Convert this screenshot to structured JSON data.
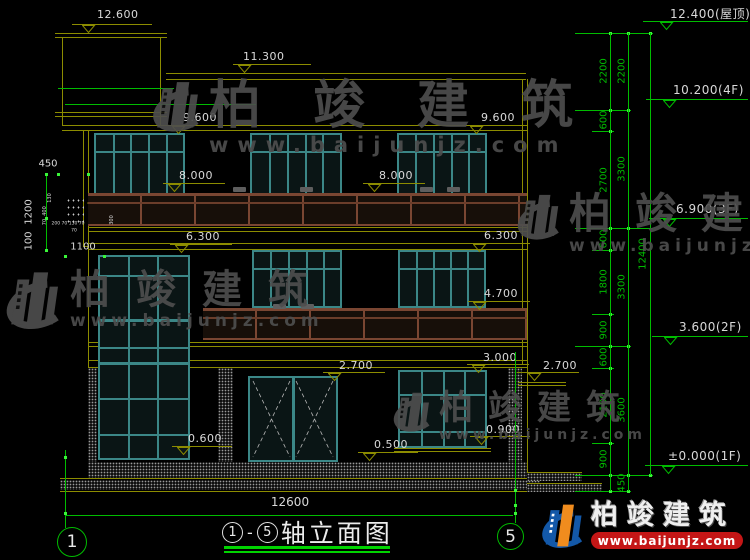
{
  "colors": {
    "line_olive": "#8c8c00",
    "dim_green": "#00bc00",
    "dot_green": "#39f539",
    "window_teal": "#3b8787",
    "railing_brown": "#7a4632",
    "text_white": "#d9d9d9",
    "watermark_gray": "#4e4e4e",
    "logo_blue": "#1358a8",
    "logo_orange": "#f08c1e",
    "logo_red": "#c41616"
  },
  "title_block": {
    "axis_start": "1",
    "dash": "-",
    "axis_end": "5",
    "title": "轴立面图"
  },
  "watermark": {
    "text": "柏竣建筑",
    "url": "www.baijunjz.com",
    "instances": [
      {
        "x": 137,
        "y": 80,
        "logo": 66,
        "cs": 52,
        "ls": 52,
        "us": 21,
        "uls": 9
      },
      {
        "x": -12,
        "y": 270,
        "logo": 76,
        "cs": 40,
        "ls": 26,
        "us": 17,
        "uls": 5
      },
      {
        "x": 503,
        "y": 193,
        "logo": 60,
        "cs": 42,
        "ls": 24,
        "us": 17,
        "uls": 5
      },
      {
        "x": 381,
        "y": 391,
        "logo": 52,
        "cs": 34,
        "ls": 15,
        "us": 14,
        "uls": 4
      }
    ]
  },
  "brand": {
    "text": "柏竣建筑",
    "url": "www.baijunjz.com"
  },
  "elevation_markers": [
    {
      "label": "12.600",
      "c": "o",
      "tx": 97,
      "ty": 8,
      "lx": 72,
      "ly": 24,
      "lw": 80,
      "ax": 82
    },
    {
      "label": "11.300",
      "c": "o",
      "tx": 243,
      "ty": 50,
      "lx": 233,
      "ly": 64,
      "lw": 78,
      "ax": 238
    },
    {
      "label": "9.600",
      "c": "o",
      "tx": 183,
      "ty": 111,
      "lx": 167,
      "ly": 125,
      "lw": 62,
      "ax": 172
    },
    {
      "label": "9.600",
      "c": "o",
      "tx": 481,
      "ty": 111,
      "lx": 465,
      "ly": 125,
      "lw": 62,
      "ax": 470
    },
    {
      "label": "8.000",
      "c": "o",
      "tx": 179,
      "ty": 169,
      "lx": 163,
      "ly": 183,
      "lw": 62,
      "ax": 168
    },
    {
      "label": "8.000",
      "c": "o",
      "tx": 379,
      "ty": 169,
      "lx": 363,
      "ly": 183,
      "lw": 62,
      "ax": 368
    },
    {
      "label": "6.300",
      "c": "o",
      "tx": 186,
      "ty": 230,
      "lx": 170,
      "ly": 244,
      "lw": 62,
      "ax": 175
    },
    {
      "label": "6.300",
      "c": "o",
      "tx": 484,
      "ty": 229,
      "lx": 468,
      "ly": 243,
      "lw": 62,
      "ax": 473
    },
    {
      "label": "4.700",
      "c": "o",
      "tx": 484,
      "ty": 287,
      "lx": 468,
      "ly": 301,
      "lw": 62,
      "ax": 473
    },
    {
      "label": "3.000",
      "c": "o",
      "tx": 483,
      "ty": 351,
      "lx": 467,
      "ly": 364,
      "lw": 62,
      "ax": 472
    },
    {
      "label": "2.700",
      "c": "o",
      "tx": 339,
      "ty": 359,
      "lx": 323,
      "ly": 372,
      "lw": 62,
      "ax": 328
    },
    {
      "label": "2.700",
      "c": "o",
      "tx": 543,
      "ty": 359,
      "lx": 517,
      "ly": 372,
      "lw": 62,
      "ax": 528
    },
    {
      "label": "0.900",
      "c": "o",
      "tx": 486,
      "ty": 423,
      "lx": 470,
      "ly": 436,
      "lw": 60,
      "ax": 475
    },
    {
      "label": "0.600",
      "c": "o",
      "tx": 188,
      "ty": 432,
      "lx": 172,
      "ly": 446,
      "lw": 60,
      "ax": 177
    },
    {
      "label": "0.500",
      "c": "o",
      "tx": 374,
      "ty": 438,
      "lx": 358,
      "ly": 452,
      "lw": 60,
      "ax": 363
    },
    {
      "label": "12.400(屋顶)",
      "c": "g",
      "tx": 670,
      "ty": 5,
      "lx": 643,
      "ly": 21,
      "lw": 105,
      "ax": 660
    },
    {
      "label": "10.200(4F)",
      "c": "g",
      "tx": 673,
      "ty": 83,
      "lx": 646,
      "ly": 99,
      "lw": 102,
      "ax": 663
    },
    {
      "label": "6.900(3F)",
      "c": "g",
      "tx": 676,
      "ty": 202,
      "lx": 649,
      "ly": 218,
      "lw": 99,
      "ax": 663
    },
    {
      "label": "3.600(2F)",
      "c": "g",
      "tx": 679,
      "ty": 320,
      "lx": 652,
      "ly": 336,
      "lw": 96,
      "ax": 664
    },
    {
      "label": "±0.000(1F)",
      "c": "g",
      "tx": 668,
      "ty": 449,
      "lx": 645,
      "ly": 465,
      "lw": 103,
      "ax": 662
    }
  ],
  "dim_labels": [
    {
      "t": "2200",
      "x": 604,
      "y": 71,
      "r": -90,
      "s": 10,
      "c": "g"
    },
    {
      "t": "600",
      "x": 604,
      "y": 120,
      "r": -90,
      "s": 10,
      "c": "g"
    },
    {
      "t": "2700",
      "x": 604,
      "y": 180,
      "r": -90,
      "s": 10,
      "c": "g"
    },
    {
      "t": "600",
      "x": 604,
      "y": 239,
      "r": -90,
      "s": 10,
      "c": "g"
    },
    {
      "t": "1800",
      "x": 604,
      "y": 282,
      "r": -90,
      "s": 10,
      "c": "g"
    },
    {
      "t": "900",
      "x": 604,
      "y": 330,
      "r": -90,
      "s": 10,
      "c": "g"
    },
    {
      "t": "600",
      "x": 604,
      "y": 357,
      "r": -90,
      "s": 10,
      "c": "g"
    },
    {
      "t": "2100",
      "x": 604,
      "y": 405,
      "r": -90,
      "s": 10,
      "c": "g"
    },
    {
      "t": "900",
      "x": 604,
      "y": 459,
      "r": -90,
      "s": 10,
      "c": "g"
    },
    {
      "t": "2200",
      "x": 622,
      "y": 71,
      "r": -90,
      "s": 10,
      "c": "g"
    },
    {
      "t": "3300",
      "x": 622,
      "y": 169,
      "r": -90,
      "s": 10,
      "c": "g"
    },
    {
      "t": "3300",
      "x": 622,
      "y": 287,
      "r": -90,
      "s": 10,
      "c": "g"
    },
    {
      "t": "3600",
      "x": 622,
      "y": 410,
      "r": -90,
      "s": 10,
      "c": "g"
    },
    {
      "t": "450",
      "x": 622,
      "y": 483,
      "r": -90,
      "s": 10,
      "c": "g"
    },
    {
      "t": "12400",
      "x": 643,
      "y": 254,
      "r": -90,
      "s": 10,
      "c": "g"
    },
    {
      "t": "450",
      "x": 48,
      "y": 164,
      "r": 0,
      "s": 10,
      "c": "w"
    },
    {
      "t": "1200",
      "x": 29,
      "y": 212,
      "r": -90,
      "s": 10,
      "c": "w"
    },
    {
      "t": "100",
      "x": 29,
      "y": 241,
      "r": -90,
      "s": 10,
      "c": "w"
    },
    {
      "t": "1100",
      "x": 83,
      "y": 247,
      "r": 0,
      "s": 10,
      "c": "w"
    },
    {
      "t": "12600",
      "x": 290,
      "y": 502,
      "r": 0,
      "s": 12,
      "c": "w"
    },
    {
      "t": "130",
      "x": 50,
      "y": 198,
      "r": -90,
      "s": 5,
      "c": "w"
    },
    {
      "t": "400",
      "x": 45,
      "y": 211,
      "r": -90,
      "s": 5,
      "c": "w"
    },
    {
      "t": "70",
      "x": 45,
      "y": 222,
      "r": -90,
      "s": 5,
      "c": "w"
    },
    {
      "t": "200 70 130 70",
      "x": 68,
      "y": 224,
      "r": 0,
      "s": 4.5,
      "c": "w"
    },
    {
      "t": "70",
      "x": 74,
      "y": 231,
      "r": 0,
      "s": 4.5,
      "c": "w"
    },
    {
      "t": "300",
      "x": 112,
      "y": 220,
      "r": -90,
      "s": 5,
      "c": "w"
    }
  ],
  "green": {
    "rows": [
      {
        "y": 33,
        "x1": 575,
        "x2": 653,
        "dots": [
          610,
          628,
          650
        ]
      },
      {
        "y": 110,
        "x1": 575,
        "x2": 631,
        "dots": [
          610,
          628
        ]
      },
      {
        "y": 131,
        "x1": 592,
        "x2": 614,
        "dots": [
          610
        ]
      },
      {
        "y": 228,
        "x1": 575,
        "x2": 653,
        "dots": [
          610,
          628
        ]
      },
      {
        "y": 250,
        "x1": 592,
        "x2": 614,
        "dots": [
          610
        ]
      },
      {
        "y": 314,
        "x1": 592,
        "x2": 614,
        "dots": [
          610
        ]
      },
      {
        "y": 346,
        "x1": 575,
        "x2": 631,
        "dots": [
          610,
          628
        ]
      },
      {
        "y": 368,
        "x1": 592,
        "x2": 614,
        "dots": [
          610
        ]
      },
      {
        "y": 443,
        "x1": 592,
        "x2": 614,
        "dots": [
          610
        ]
      },
      {
        "y": 475,
        "x1": 575,
        "x2": 653,
        "dots": [
          610,
          628,
          650
        ]
      },
      {
        "y": 491,
        "x1": 575,
        "x2": 631,
        "dots": [
          610,
          628
        ]
      }
    ],
    "vlines": [
      [
        610,
        33,
        491
      ],
      [
        628,
        33,
        491
      ],
      [
        650,
        33,
        475
      ],
      [
        65,
        450,
        528
      ],
      [
        515,
        352,
        523
      ],
      [
        46,
        174,
        252
      ]
    ],
    "hlines": [
      [
        65,
        513,
        515
      ],
      [
        58,
        174,
        88
      ],
      [
        65,
        256,
        104
      ]
    ],
    "dots": [
      [
        65,
        457
      ],
      [
        65,
        513
      ],
      [
        515,
        513
      ],
      [
        515,
        490
      ],
      [
        515,
        505
      ],
      [
        58,
        174
      ],
      [
        88,
        174
      ],
      [
        46,
        174
      ],
      [
        46,
        218
      ],
      [
        46,
        250
      ],
      [
        65,
        256
      ],
      [
        104,
        256
      ]
    ]
  },
  "axis_bubbles": [
    {
      "label": "1",
      "x": 57,
      "y": 527,
      "d": 30
    },
    {
      "label": "5",
      "x": 497,
      "y": 523,
      "d": 27
    }
  ]
}
